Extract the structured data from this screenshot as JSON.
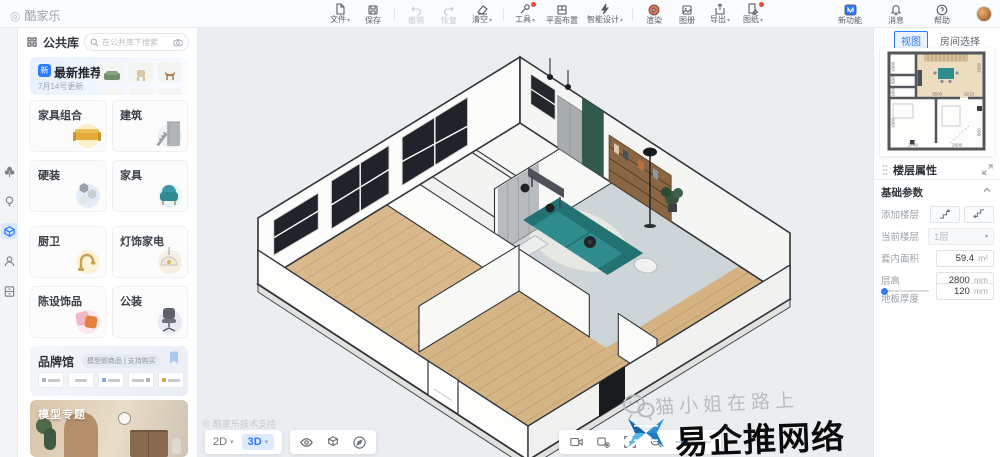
{
  "topbar": {
    "logo": "酷家乐",
    "items": [
      "文件",
      "保存",
      "撤销",
      "恢复",
      "清空",
      "工具",
      "平面布置",
      "智能设计",
      "渲染",
      "图册",
      "导出",
      "图纸"
    ],
    "right_items": [
      "新功能",
      "消息",
      "帮助"
    ]
  },
  "sidebar": {
    "library_tab": "公共库",
    "search_placeholder": "在公共库下搜索",
    "recommend_title": "最新推荐",
    "recommend_subtitle": "7月14号更新",
    "categories": [
      "家具组合",
      "建筑",
      "硬装",
      "家具",
      "厨卫",
      "灯饰家电",
      "陈设饰品",
      "公装"
    ],
    "brand_title": "品牌馆",
    "brand_tag": "模型即商品 | 支持购买",
    "banner_title": "模型专题"
  },
  "canvas": {
    "support_text": "酷家乐技术支持",
    "mode_2d": "2D",
    "mode_3d": "3D",
    "watermark_handle": "猫小姐在路上",
    "watermark_brand": "易企推网络"
  },
  "right_panel": {
    "tab_view": "视图",
    "tab_room": "房间选择",
    "props_title": "楼层属性",
    "section_title": "基础参数",
    "add_floor_label": "添加楼层",
    "current_floor_label": "当前楼层",
    "current_floor_value": "1层",
    "area_label": "套内面积",
    "area_value": "59.4",
    "area_unit": "m²",
    "floor_height_label": "层高",
    "floor_height_value": "2800",
    "floor_height_unit": "mm",
    "slab_label": "地板厚度",
    "slab_value": "120",
    "slab_unit": "mm",
    "dims": [
      "1800",
      "600",
      "1800",
      "1800",
      "3500",
      "3210",
      "2740",
      "2600",
      "1500",
      "800"
    ]
  },
  "icons": {
    "caret": "▾",
    "ring": "◎"
  },
  "colors": {
    "accent": "#2b7bff",
    "wood": "#d9b98c",
    "sofa_teal": "#2e8c8d",
    "green_wall": "#315a4c"
  }
}
